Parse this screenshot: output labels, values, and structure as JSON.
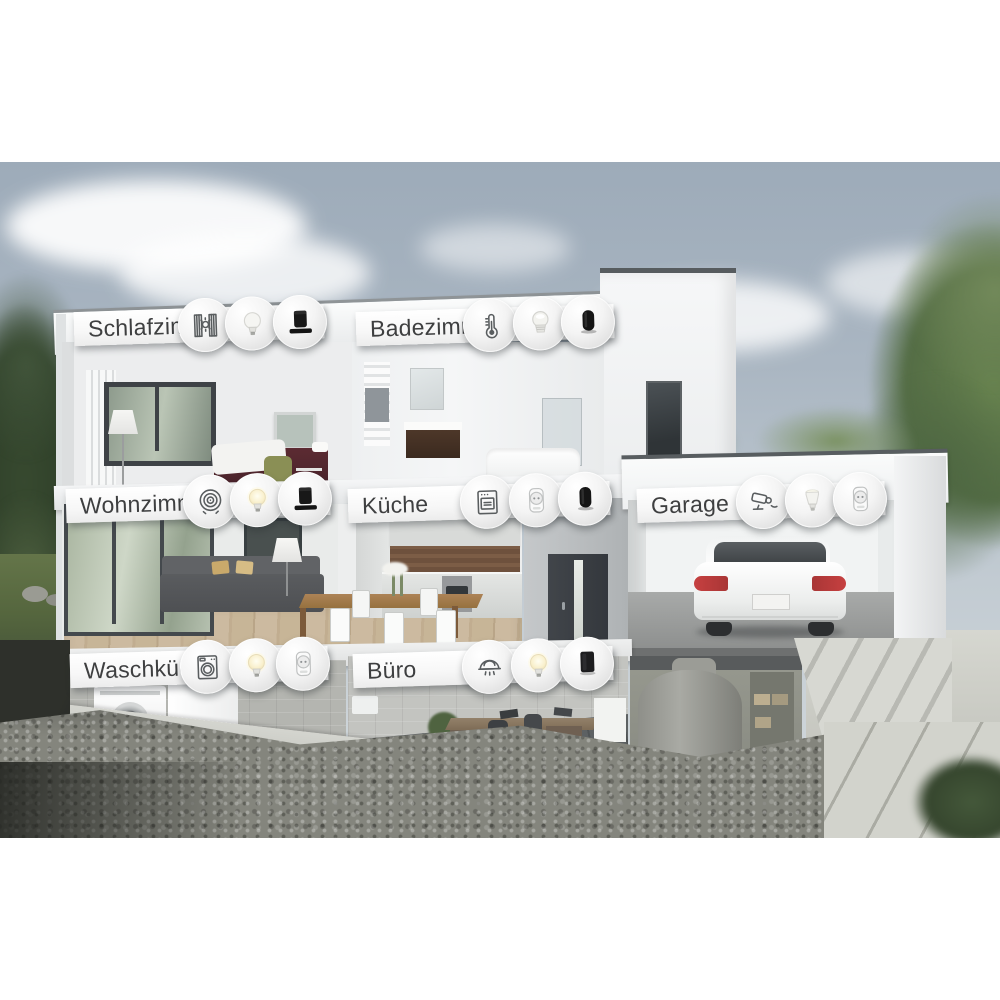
{
  "scene": {
    "type": "smart-home-cutaway-house-illustration",
    "description": "3D cutaway rendering of a modern white house showing seven labeled rooms with smart-home device icons",
    "colors": {
      "background": "#ffffff",
      "sky": "#aab6c2",
      "label_background": "#ffffff",
      "label_text": "#3e3f40",
      "house_wall": "#f2f3f4",
      "car_taillight_red": "#c64040",
      "tree_green": "#5d7a4e",
      "earth_dark": "#2b2d2a"
    }
  },
  "rooms": [
    {
      "label": "Schlafzimmer",
      "icons": [
        "roller-shutter-icon",
        "bulb-icon",
        "smart-speaker-icon"
      ]
    },
    {
      "label": "Badezimmer",
      "icons": [
        "thermostat-icon",
        "spot-bulb-icon",
        "smart-speaker-icon"
      ]
    },
    {
      "label": "Wohnzimmer",
      "icons": [
        "robot-vacuum-icon",
        "glowing-bulb-icon",
        "smart-speaker-icon"
      ]
    },
    {
      "label": "Küche",
      "icons": [
        "oven-icon",
        "smart-plug-icon",
        "smart-speaker-icon"
      ]
    },
    {
      "label": "Garage",
      "icons": [
        "security-camera-icon",
        "flood-bulb-icon",
        "smart-plug-icon"
      ]
    },
    {
      "label": "Waschküche",
      "icons": [
        "washing-machine-icon",
        "glowing-bulb-icon",
        "smart-plug-icon"
      ]
    },
    {
      "label": "Büro",
      "icons": [
        "smoke-detector-icon",
        "glowing-bulb-icon",
        "smart-speaker-icon"
      ]
    }
  ]
}
